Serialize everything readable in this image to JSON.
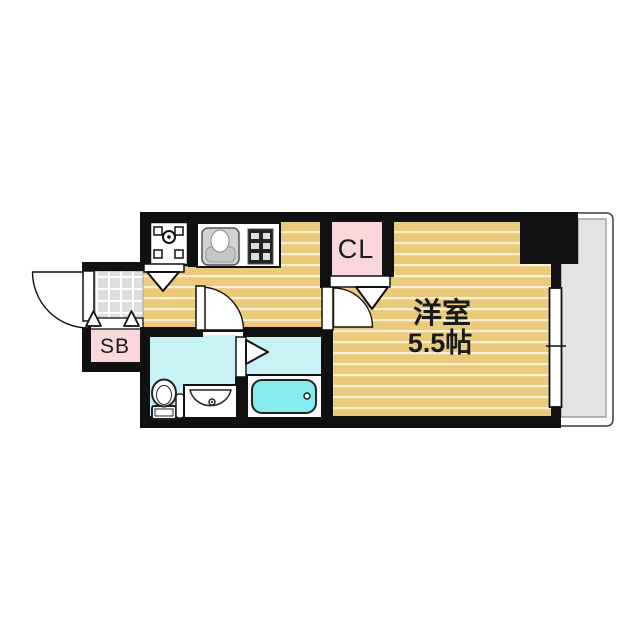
{
  "plan": {
    "type": "apartment-floorplan",
    "labels": {
      "closet": "CL",
      "shoebox": "SB",
      "main_room_name": "洋室",
      "main_room_size": "5.5帖"
    },
    "rooms": [
      {
        "name": "洋室 5.5帖",
        "kind": "western-room",
        "floor": "wood"
      },
      {
        "name": "CL",
        "kind": "closet"
      },
      {
        "name": "SB",
        "kind": "shoe-box"
      },
      {
        "kind": "kitchen-hallway",
        "floor": "wood"
      },
      {
        "kind": "entrance",
        "floor": "tile"
      },
      {
        "kind": "washroom",
        "floor": "wet"
      },
      {
        "kind": "bathroom",
        "floor": "wet"
      },
      {
        "kind": "balcony",
        "floor": "concrete"
      }
    ],
    "fixtures": [
      "washing-machine-pan",
      "kitchen-sink",
      "stove",
      "toilet",
      "vanity-sink",
      "bathtub",
      "sliding-window",
      "swing-doors",
      "folding-doors"
    ],
    "colors": {
      "wall": "#111111",
      "wood_floor": "#ecca7c",
      "floor_stripe": "#faf0d2",
      "tile": "#e0e0e0",
      "wet_floor": "#c7f3f6",
      "bathtub": "#86ebee",
      "accent_pink": "#f9d7da",
      "balcony": "#e3e3e3"
    }
  }
}
